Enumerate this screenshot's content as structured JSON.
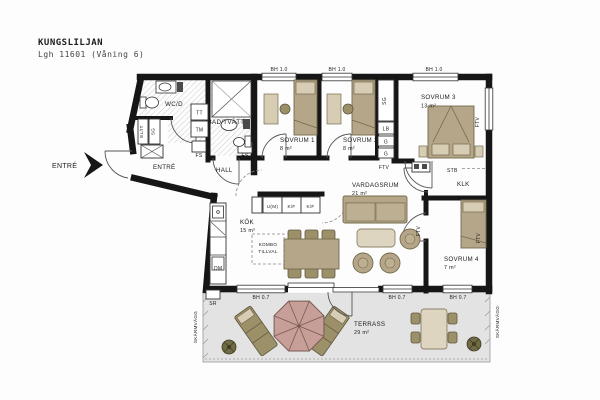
{
  "header": {
    "title": "KUNGSLILJAN",
    "subtitle": "Lgh 11601 (Våning 6)"
  },
  "entrance": {
    "label": "ENTRÉ"
  },
  "rooms": {
    "entre": {
      "name": "ENTRÉ"
    },
    "hall": {
      "name": "HALL"
    },
    "wcd": {
      "name": "WC/D"
    },
    "bad": {
      "name": "BAD/TVÄTT"
    },
    "sovrum1": {
      "name": "SOVRUM 1",
      "area": "8 m²"
    },
    "sovrum2": {
      "name": "SOVRUM 2",
      "area": "8 m²"
    },
    "sovrum3": {
      "name": "SOVRUM 3",
      "area": "13 m²"
    },
    "sovrum4": {
      "name": "SOVRUM 4",
      "area": "7 m²"
    },
    "vardagsrum": {
      "name": "VARDAGSRUM",
      "area": "21 m²"
    },
    "kok": {
      "name": "KÖK",
      "area": "15 m²"
    },
    "klk": {
      "name": "KLK"
    },
    "terrass": {
      "name": "TERRASS",
      "area": "29 m²"
    }
  },
  "labels": {
    "bh10": "BH 1.0",
    "bh07": "BH 0.7",
    "ftv": "FTV",
    "stb": "STB",
    "sg": "SG",
    "lb": "LB",
    "g": "G",
    "tt": "TT",
    "tm": "TM",
    "fs": "FS",
    "elit": "EL/IT",
    "dm": "DM",
    "sr": "SR",
    "um": "U(M)",
    "kf": "K/F",
    "kombo1": "KOMBO",
    "kombo2": "TILLVAL",
    "skarmvagg": "SKÄRMVÄGG"
  },
  "colors": {
    "wall": "#161616",
    "furniture": "#b5a689",
    "furniture_light": "#d6cdb4",
    "parasol": "#c79f98",
    "terrace": "#e3e3e3",
    "hatch": "#c9c9c9"
  }
}
